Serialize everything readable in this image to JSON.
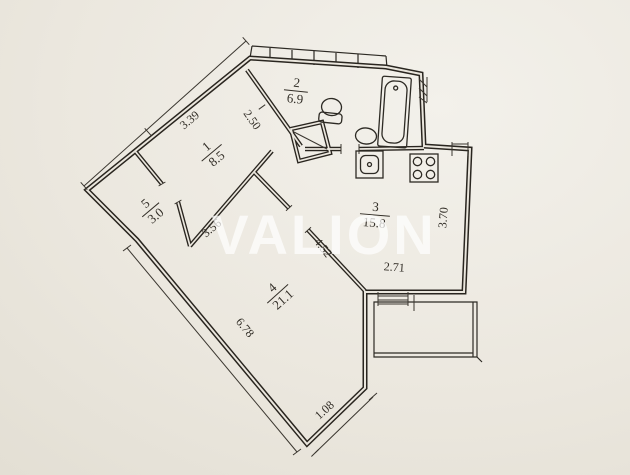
{
  "watermark": "VALION",
  "plan": {
    "type": "apartment-floor-plan",
    "rooms": [
      {
        "id": "room-1",
        "number": "1",
        "area": "8.5"
      },
      {
        "id": "room-2",
        "number": "2",
        "area": "6.9"
      },
      {
        "id": "room-3",
        "number": "3",
        "area": "15.8"
      },
      {
        "id": "room-4",
        "number": "4",
        "area": "21.1"
      },
      {
        "id": "room-5",
        "number": "5",
        "area": "3.0"
      }
    ],
    "dimensions": [
      {
        "id": "dim-339",
        "value": "3.39"
      },
      {
        "id": "dim-250",
        "value": "2.50"
      },
      {
        "id": "dim-356",
        "value": "3.56"
      },
      {
        "id": "dim-452",
        "value": "4.52"
      },
      {
        "id": "dim-370",
        "value": "3.70"
      },
      {
        "id": "dim-271",
        "value": "2.71"
      },
      {
        "id": "dim-678",
        "value": "6.78"
      },
      {
        "id": "dim-108",
        "value": "1.08"
      }
    ],
    "fixtures": [
      "toilet",
      "sink",
      "bathtub",
      "washing-machine",
      "stove"
    ],
    "features": [
      "window-band",
      "balcony",
      "vent-shaft",
      "window-sill"
    ],
    "colors": {
      "paper": "#ebe7de",
      "ink": "#29251f",
      "watermark": "#ffffff"
    }
  }
}
